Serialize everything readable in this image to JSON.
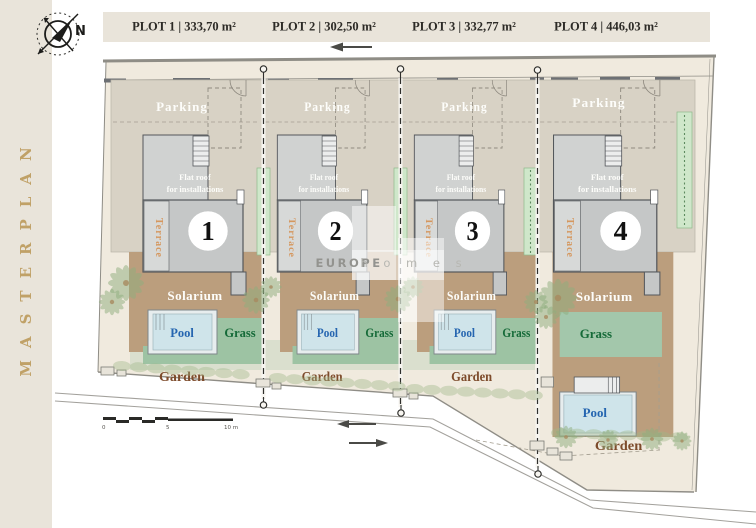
{
  "sidebar": {
    "title": "MASTERPLAN"
  },
  "header": {
    "plot_labels": [
      "PLOT 1 | 333,70 m²",
      "PLOT 2 | 302,50 m²",
      "PLOT 3 | 332,77 m²",
      "PLOT 4 | 446,03 m²"
    ]
  },
  "compass": {
    "north": "N"
  },
  "plan": {
    "labels": {
      "parking": "Parking",
      "flat_roof_line1": "Flat roof",
      "flat_roof_line2": "for installations",
      "terrace": "Terrace",
      "solarium": "Solarium",
      "pool": "Pool",
      "grass": "Grass",
      "garden": "Garden"
    },
    "plot_numbers": [
      "1",
      "2",
      "3",
      "4"
    ]
  },
  "watermark": {
    "brand": "EUROPE",
    "brand_suffix": "h o m e s"
  },
  "scale_bar": {
    "start": "0",
    "middle": "5",
    "end": "10 m"
  },
  "colors": {
    "beige": "#e9e4da",
    "site_cream": "#f0eade",
    "parking": "#d8d2c5",
    "solarium_tan": "#bb9e7d",
    "building_gray": "#c5c7c7",
    "grass_green": "#9dc3a3",
    "pool_water": "#cfe4ea",
    "pool_text": "#2565b0",
    "grass_text": "#156a38",
    "garden_text": "#7d4b2b",
    "terrace_text": "#d5975e",
    "masterplan_gold": "#c0a167"
  }
}
